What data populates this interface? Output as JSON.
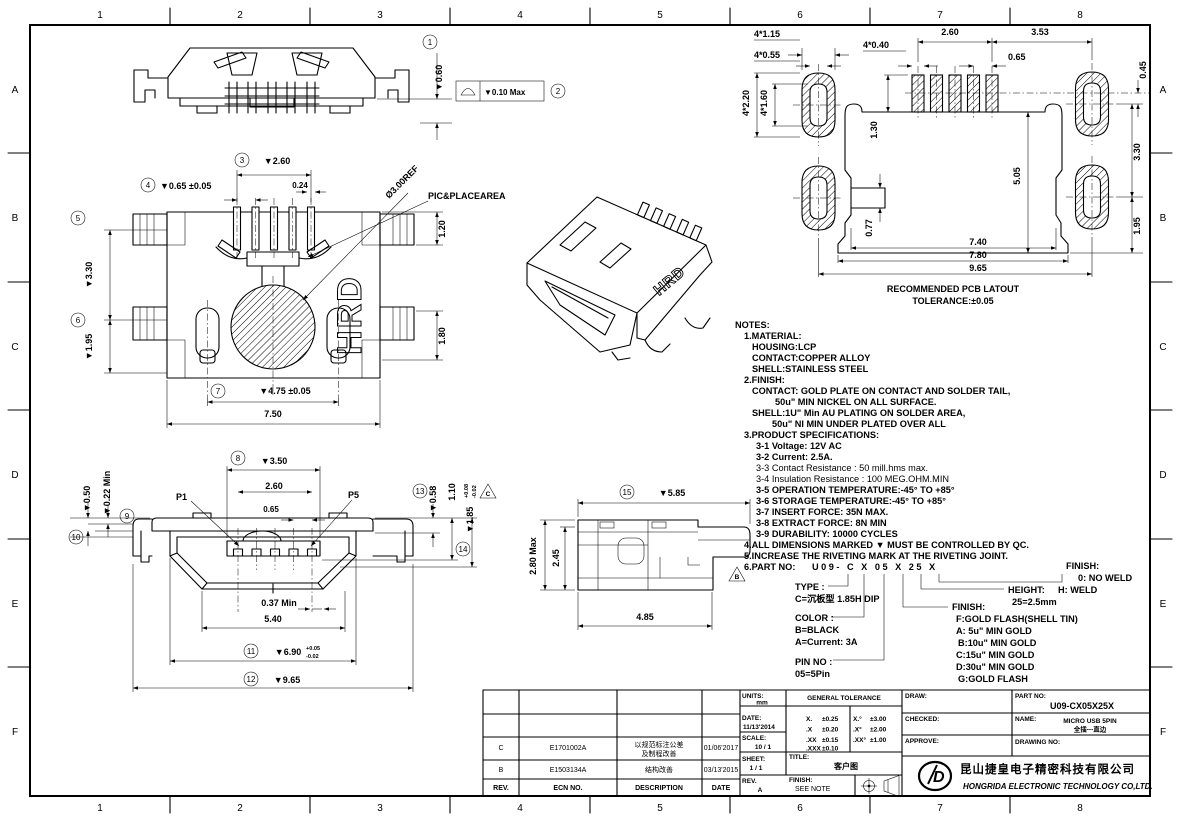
{
  "sheet": {
    "grid_columns": [
      "1",
      "2",
      "3",
      "4",
      "5",
      "6",
      "7",
      "8"
    ],
    "grid_rows": [
      "A",
      "B",
      "C",
      "D",
      "E",
      "F"
    ]
  },
  "balloons": [
    "1",
    "2",
    "3",
    "4",
    "5",
    "6",
    "7",
    "8",
    "9",
    "10",
    "11",
    "12",
    "13",
    "14",
    "15"
  ],
  "flags": {
    "b": "B",
    "c": "C"
  },
  "rear_view": {
    "height": "▼0.60",
    "flatness": "▼0.10 Max"
  },
  "bottom_view": {
    "pin_span": "▼2.60",
    "pin_width": "0.24",
    "pin_pitch": "▼0.65 ±0.05",
    "upper_height": "▼3.30",
    "lower_height": "▼1.95",
    "post_span": "▼4.75 ±0.05",
    "body_width": "7.50",
    "edge_top": "1.20",
    "edge_mid": "1.80",
    "pick_dia": "Ø3.00REF",
    "pick_label": "PIC&PLACEAREA",
    "marking": "HRD"
  },
  "front_view": {
    "tongue_width": "▼3.50",
    "contact_span": "2.60",
    "contact_pitch": "0.65",
    "pin_first": "P1",
    "pin_last": "P5",
    "step_left": "▼0.50",
    "step_min": "▼0.22 Min",
    "step_right": "▼0.58",
    "tongue_drop": "1.10",
    "shell_height": "▼1.85",
    "shell_height_tol_plus": "+0.08",
    "shell_height_tol_minus": "-0.02",
    "gap_min": "0.37 Min",
    "opening_width": "5.40",
    "shell_width": "▼6.90",
    "shell_width_tol_plus": "+0.05",
    "shell_width_tol_minus": "-0.02",
    "overall_width": "▼9.65"
  },
  "side_view": {
    "length": "▼5.85",
    "height_max": "2.80 Max",
    "height": "2.45",
    "base_length": "4.85"
  },
  "pcb_view": {
    "pad_w": "4*1.15",
    "pad_iw": "4*0.55",
    "hole_w": "4*0.40",
    "pitch_span": "2.60",
    "pad_offset": "3.53",
    "pitch": "0.65",
    "row_offset": "0.45",
    "pad_h": "4*2.20",
    "pad_ih": "4*1.60",
    "hole_h": "1.30",
    "depth": "5.05",
    "row_gap": "3.30",
    "edge_gap": "1.95",
    "step": "0.77",
    "w1": "7.40",
    "w2": "7.80",
    "w3": "9.65",
    "caption1": "RECOMMENDED PCB LATOUT",
    "caption2": "TOLERANCE:±0.05"
  },
  "notes": {
    "title": "NOTES:",
    "lines": [
      "1.MATERIAL:",
      "HOUSING:LCP",
      "CONTACT:COPPER ALLOY",
      "SHELL:STAINLESS STEEL",
      "2.FINISH:",
      "CONTACT: GOLD PLATE ON CONTACT AND SOLDER TAIL,",
      "50u\" MIN NICKEL ON ALL SURFACE.",
      "SHELL:1U\" Min AU PLATING ON SOLDER AREA,",
      "50u\" NI MIN UNDER PLATED OVER ALL",
      "3.PRODUCT SPECIFICATIONS:",
      "3-1 Voltage: 12V AC",
      "3-2 Current: 2.5A.",
      "3-3 Contact Resistance : 50 mill.hms max.",
      "3-4 Insulation Resistance : 100 MEG.OHM.MIN",
      "3-5 OPERATION TEMPERATURE:-45° TO +85°",
      "3-6 STORAGE TEMPERATURE:-45° TO +85°",
      "3-7 INSERT FORCE: 35N MAX.",
      "3-8 EXTRACT FORCE: 8N MIN",
      "3-9 DURABILITY: 10000 CYCLES",
      "4.ALL DIMENSIONS MARKED ▼ MUST BE CONTROLLED BY QC.",
      "5.INCREASE THE RIVETING MARK AT THE RIVETING JOINT."
    ],
    "part_no_label": "6.PART NO:",
    "part_no_code": "U09- C X 05 X 25 X"
  },
  "part_legend": {
    "type_label": "TYPE :",
    "type_value": "C=沉板型 1.85H DIP",
    "color_label": "COLOR :",
    "color_value1": "B=BLACK",
    "color_value2": "A=Current: 3A",
    "pin_label": "PIN NO :",
    "pin_value": "05=5Pin",
    "finish_label": "FINISH:",
    "finish_options": [
      "F:GOLD FLASH(SHELL TIN)",
      "A: 5u\" MIN GOLD",
      "B:10u\" MIN GOLD",
      "C:15u\" MIN GOLD",
      "D:30u\" MIN GOLD",
      "G:GOLD FLASH"
    ],
    "height_label": "HEIGHT:",
    "height_value": "25=2.5mm",
    "weld_label": "FINISH:",
    "weld_options": [
      "0: NO WELD",
      "H: WELD"
    ]
  },
  "revisions": {
    "header": {
      "rev": "REV.",
      "ecn": "ECN NO.",
      "desc": "DESCRIPTION",
      "date": "DATE"
    },
    "rows": [
      {
        "rev": "C",
        "ecn": "E1701002A",
        "desc1": "以规范标注公差",
        "desc2": "及制程改善",
        "date": "01/06'2017"
      },
      {
        "rev": "B",
        "ecn": "E1503134A",
        "desc1": "结构改善",
        "desc2": "",
        "date": "03/13'2015"
      }
    ]
  },
  "title_block": {
    "units_label": "UNITS:",
    "units": "mm",
    "date_label": "DATE:",
    "date": "11/13'2014",
    "scale_label": "SCALE:",
    "scale": "10 / 1",
    "sheet_label": "SHEET:",
    "sheet": "1 / 1",
    "rev_label": "REV.",
    "rev": "A",
    "tolerance_header": "GENERAL TOLERANCE",
    "tolerance": [
      [
        "X.",
        "±0.25",
        "X.°",
        "±3.00"
      ],
      [
        ".X",
        "±0.20",
        ".X°",
        "±2.00"
      ],
      [
        ".XX",
        "±0.15",
        ".XX°",
        "±1.00"
      ],
      [
        ".XXX",
        "±0.10",
        "",
        ""
      ]
    ],
    "draw_label": "DRAW:",
    "checked_label": "CHECKED:",
    "approve_label": "APPROVE:",
    "title_label": "TITLE:",
    "title": "客户图",
    "finish_label": "FINISH:",
    "finish": "SEE NOTE",
    "part_no_label": "PART NO:",
    "part_no": "U09-CX05X25X",
    "name_label": "NAME:",
    "name_line1": "MICRO USB 5PIN",
    "name_line2": "全插---直边",
    "drawing_no_label": "DRAWING NO:",
    "company_cn": "昆山捷皇电子精密科技有限公司",
    "company_en": "HONGRIDA ELECTRONIC TECHNOLOGY CO,LTD."
  }
}
